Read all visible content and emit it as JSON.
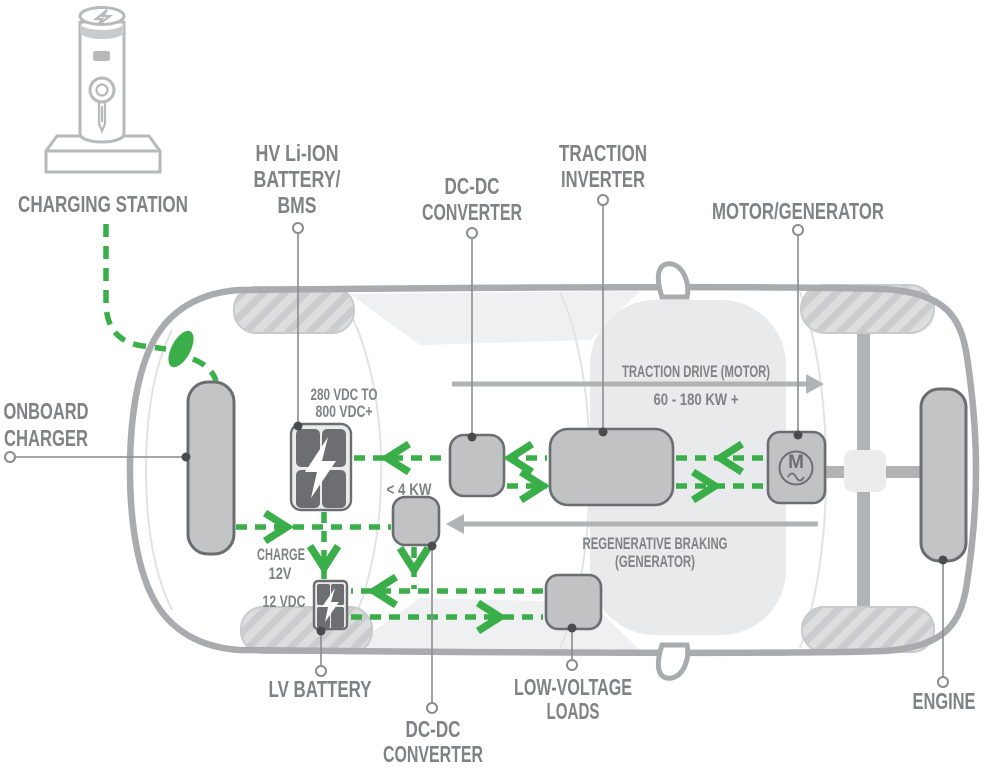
{
  "diagram": {
    "callouts": {
      "charging_station": {
        "label": "CHARGING STATION"
      },
      "hv_battery": {
        "line1": "HV Li-ION",
        "line2": "BATTERY/",
        "line3": "BMS"
      },
      "dcdc_converter_top": {
        "line1": "DC-DC",
        "line2": "CONVERTER"
      },
      "traction_inverter": {
        "line1": "TRACTION",
        "line2": "INVERTER"
      },
      "motor_generator": {
        "label": "MOTOR/GENERATOR"
      },
      "onboard_charger": {
        "line1": "ONBOARD",
        "line2": "CHARGER"
      },
      "lv_battery": {
        "label": "LV BATTERY"
      },
      "dcdc_converter_bottom": {
        "line1": "DC-DC",
        "line2": "CONVERTER"
      },
      "low_voltage_loads": {
        "line1": "LOW-VOLTAGE",
        "line2": "LOADS"
      },
      "engine": {
        "label": "ENGINE"
      }
    },
    "annotations": {
      "hv_bus_voltage": {
        "line1": "280 VDC TO",
        "line2": "800 VDC+"
      },
      "dcdc_power": "< 4 KW",
      "charge": {
        "line1": "CHARGE",
        "line2": "12V"
      },
      "lv_voltage": "12 VDC",
      "traction_drive": {
        "line1": "TRACTION DRIVE (MOTOR)",
        "line2": "60 - 180 KW +"
      },
      "regen_braking": {
        "line1": "REGENERATIVE BRAKING",
        "line2": "(GENERATOR)"
      }
    },
    "motor_symbol": "M",
    "colors": {
      "flow_green": "#3aae49",
      "label_gray": "#808285",
      "component_fill": "#c0c2c4",
      "component_stroke": "#6b6d70",
      "battery_cell": "#6d6e71",
      "body_outline": "#a9abae",
      "driveline": "#b1b3b5",
      "wheel_fill": "#dcdddd",
      "wheel_hatch": "#cbccce",
      "cabin_shade": "#e9eaeb"
    }
  }
}
